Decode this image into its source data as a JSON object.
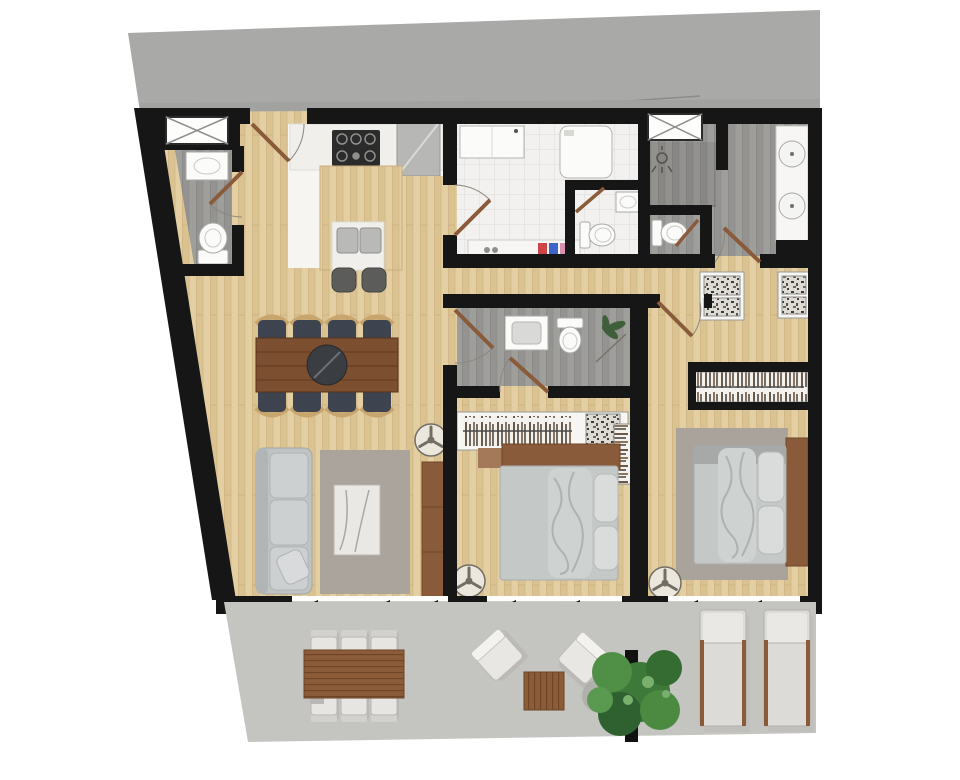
{
  "scene": {
    "type": "architectural-floor-plan",
    "view": "top-down-render",
    "subject": "two-bedroom apartment with terrace"
  },
  "palette": {
    "background": "#ffffff",
    "street": "#c6c6c4",
    "street_edge": "#a2a2a0",
    "wall": "#161616",
    "wood": "#e3cfa1",
    "wood_line": "#c8ad7f",
    "bath_floor": "#9c9c99",
    "tile": "#f2f1ef",
    "counter": "#f1efec",
    "appliance": "#b7b7b5",
    "stove": "#2b2b2b",
    "sofa": "#c0c3c4",
    "rug": "#b4aea6",
    "coffee_table": "#e9e8e5",
    "sideboard": "#8a5b3a",
    "dining_table": "#7c4f30",
    "chair_seat": "#3e4350",
    "chair_back": "#c9a56e",
    "bed": "#c4c8c7",
    "pillow": "#d9dcdb",
    "headboard": "#8a5b3a",
    "terrace": "#e1e0dc",
    "outdoor_wood": "#8c5c38",
    "outdoor_chair": "#e6e5e2",
    "tree_dark": "#2f6130",
    "tree_mid": "#3d7a3a",
    "tree_light": "#5a9a50",
    "fixture": "#fbfbfa",
    "fixture_line": "#a8a8a5",
    "door": "#8a5b3a"
  },
  "rooms": [
    {
      "id": "street-sidewalk",
      "floor": "concrete"
    },
    {
      "id": "entry-foyer",
      "floor": "wood",
      "features": [
        "entry-door-arc",
        "x-closet"
      ]
    },
    {
      "id": "powder-room",
      "floor": "gray-wood",
      "fixtures": [
        "sink",
        "toilet",
        "door-arc"
      ]
    },
    {
      "id": "kitchen",
      "floor": "white",
      "fixtures": [
        "gas-stove",
        "refrigerator",
        "wood-island",
        "double-sink",
        "bar-stool",
        "bar-stool"
      ]
    },
    {
      "id": "laundry-room",
      "floor": "white-tile",
      "fixtures": [
        "cabinet",
        "washing-machine",
        "supply-counter",
        "door-arc"
      ]
    },
    {
      "id": "wc-laundry",
      "fixtures": [
        "small-sink",
        "toilet"
      ]
    },
    {
      "id": "wc-master",
      "fixtures": [
        "toilet"
      ]
    },
    {
      "id": "master-bathroom",
      "floor": "gray-wood",
      "fixtures": [
        "x-closet",
        "shower",
        "double-sink-vanity",
        "door-arc"
      ]
    },
    {
      "id": "living-dining-room",
      "floor": "wood",
      "furniture": [
        "dining-table",
        "dining-chairs",
        "sofa",
        "rug",
        "coffee-table",
        "sideboard",
        "ceiling-fan"
      ]
    },
    {
      "id": "bedroom-2",
      "floor": "wood",
      "furniture": [
        "double-bed",
        "headboard",
        "wardrobe-hanging",
        "wardrobe-shelf",
        "shelf-unit",
        "ceiling-fan"
      ]
    },
    {
      "id": "bedroom-2-bathroom",
      "floor": "gray-wood",
      "fixtures": [
        "sink",
        "toilet",
        "plant",
        "door-arc"
      ]
    },
    {
      "id": "master-bedroom",
      "floor": "wood",
      "furniture": [
        "double-bed",
        "headboard",
        "rug",
        "dresser",
        "dresser",
        "wardrobe-hanging",
        "ceiling-fan"
      ]
    },
    {
      "id": "terrace",
      "floor": "concrete",
      "furniture": [
        "outdoor-dining-table",
        "outdoor-dining-chairs",
        "lounge-chair",
        "lounge-chair",
        "outdoor-side-table",
        "tree-planter",
        "sun-lounger",
        "sun-lounger"
      ]
    }
  ],
  "counts": {
    "ceiling_fans": 3,
    "door_arcs": 9,
    "x_closets": 2,
    "dining_chairs_inside": 8,
    "outdoor_dining_chairs": 6,
    "sun_loungers": 2
  }
}
